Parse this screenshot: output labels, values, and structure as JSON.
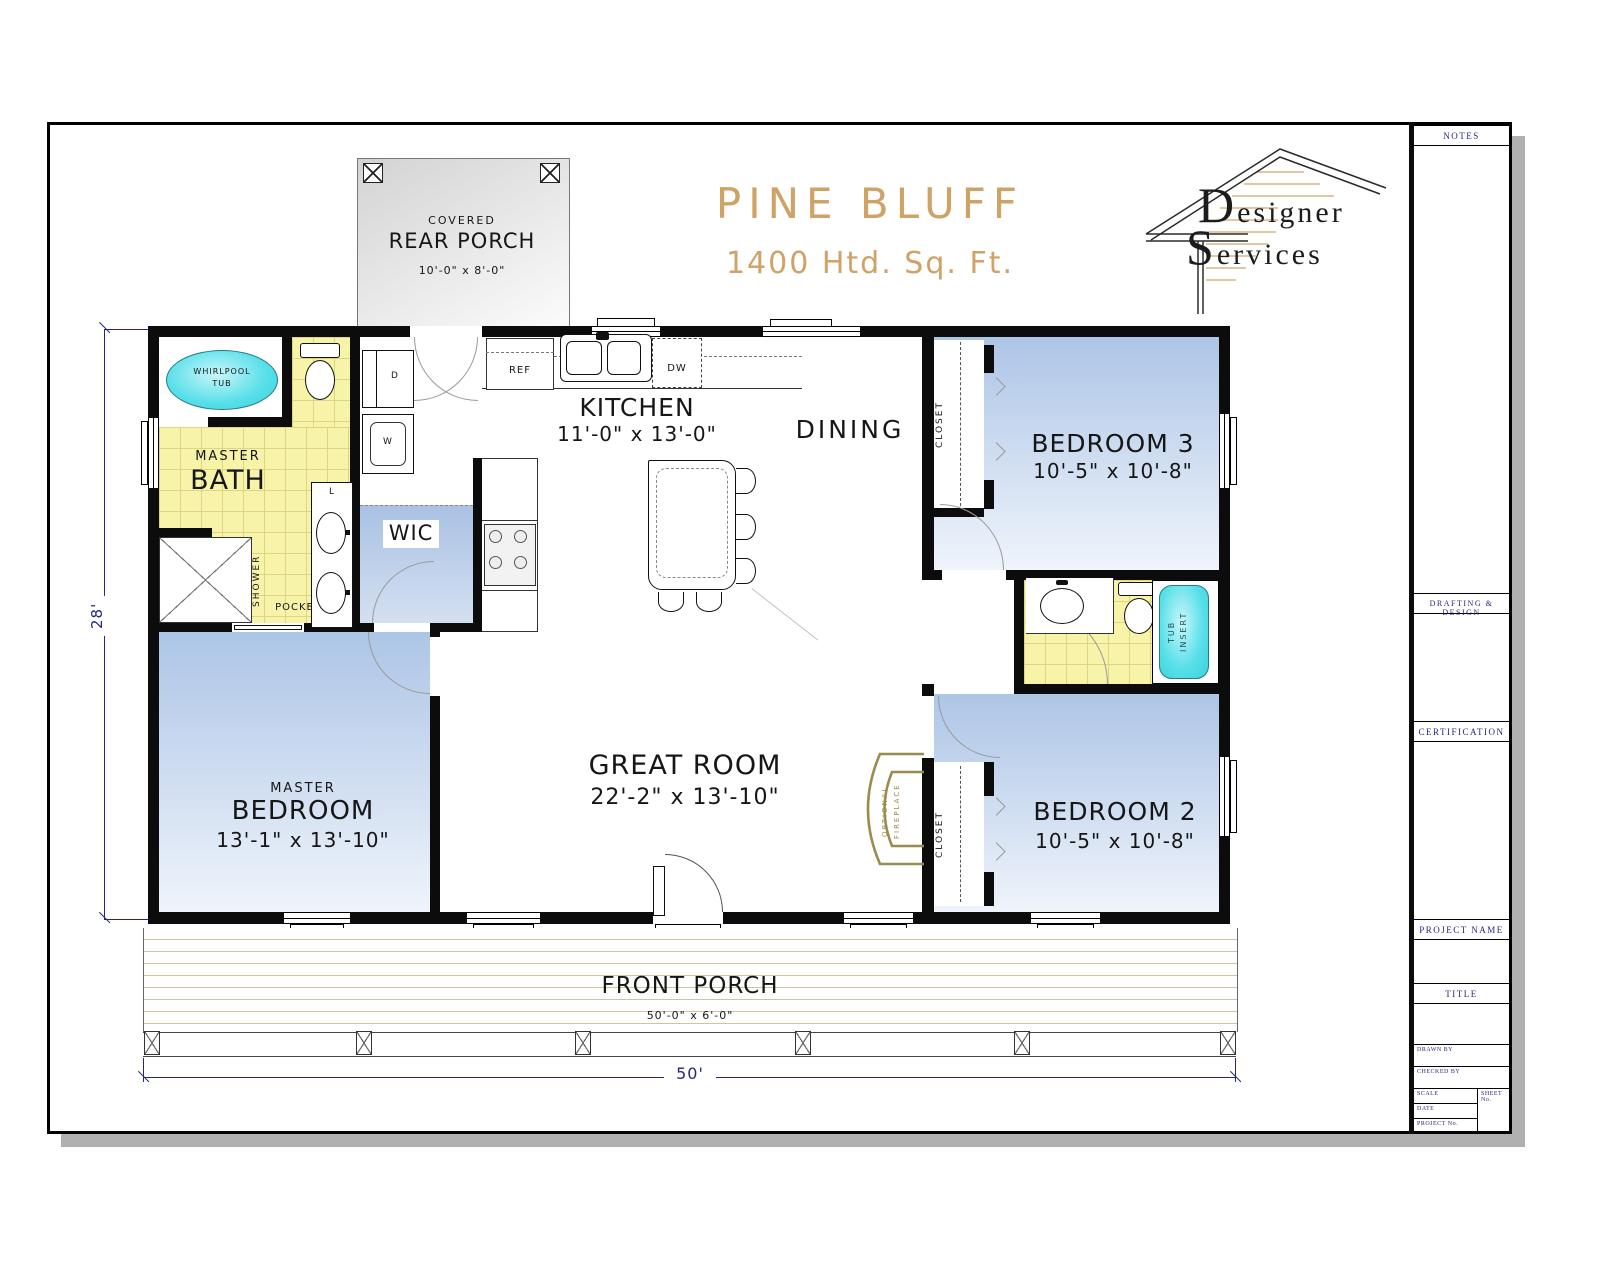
{
  "sheet": {
    "title": "PINE BLUFF",
    "subtitle": "1400 Htd. Sq. Ft.",
    "logo_line1": "Designer",
    "logo_line2": "Services"
  },
  "titleblock": {
    "notes": "NOTES",
    "drafting": "DRAFTING & DESIGN",
    "certification": "CERTIFICATION",
    "project_name": "PROJECT NAME",
    "title": "TITLE",
    "drawn_by": "DRAWN BY",
    "checked_by": "CHECKED BY",
    "scale": "SCALE",
    "date": "DATE",
    "project_no": "PROJECT No.",
    "sheet_no": "SHEET No."
  },
  "rooms": {
    "rear_porch": {
      "label1": "COVERED",
      "label2": "REAR PORCH",
      "dims": "10'-0\" x 8'-0\""
    },
    "kitchen": {
      "name": "KITCHEN",
      "dims": "11'-0\" x 13'-0\""
    },
    "dining": {
      "name": "DINING"
    },
    "bedroom3": {
      "name": "BEDROOM 3",
      "dims": "10'-5\" x 10'-8\""
    },
    "master_bath": {
      "label1": "MASTER",
      "label2": "BATH"
    },
    "wic": {
      "name": "WIC"
    },
    "great_room": {
      "name": "GREAT ROOM",
      "dims": "22'-2\" x 13'-10\""
    },
    "master_bedroom": {
      "label1": "MASTER",
      "label2": "BEDROOM",
      "dims": "13'-1\" x 13'-10\""
    },
    "bedroom2": {
      "name": "BEDROOM 2",
      "dims": "10'-5\" x 10'-8\""
    },
    "front_porch": {
      "name": "FRONT PORCH",
      "dims": "50'-0\" x 6'-0\""
    }
  },
  "fixtures": {
    "whirlpool_line1": "WHIRLPOOL",
    "whirlpool_line2": "TUB",
    "shower": "SHOWER",
    "pocket": "POCKET",
    "linen": "L",
    "dryer": "D",
    "washer": "W",
    "fridge": "REF",
    "dishwasher": "DW",
    "closet": "CLOSET",
    "tub_insert_line1": "TUB",
    "tub_insert_line2": "INSERT",
    "fireplace_line1": "OPTIONAL",
    "fireplace_line2": "FIREPLACE"
  },
  "dimensions": {
    "overall_width": "50'",
    "overall_depth": "28'"
  },
  "colors": {
    "accent_tan": "#CFA266",
    "navy": "#26267E",
    "tile_yellow": "#F7F3A8",
    "room_blue": "#ADC5E6",
    "tub_cyan": "#56DFE9",
    "fireplace_olive": "#9A8B4F"
  }
}
